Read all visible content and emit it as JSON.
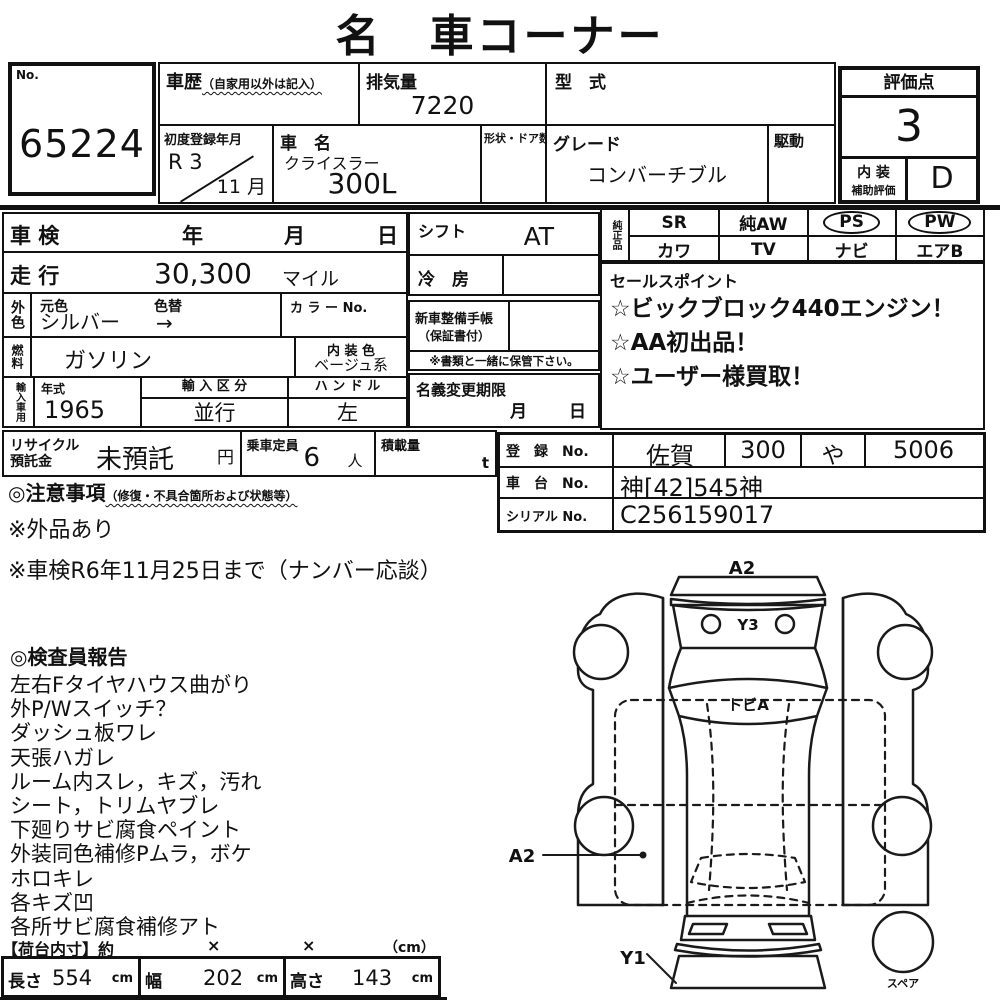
{
  "title": "名　車コーナー",
  "no_box": {
    "label": "No.",
    "value": "65224"
  },
  "header": {
    "history_label": "車歴",
    "history_note": "（自家用以外は記入）",
    "displacement_label": "排気量",
    "displacement_value": "7220",
    "model_code_label": "型　式",
    "first_reg_label": "初度登録年月",
    "first_reg_year": "R 3",
    "first_reg_month": "11 月",
    "car_name_label": "車　名",
    "car_maker": "クライスラー",
    "car_model": "300L",
    "body_doors_label": "形状・ドア数",
    "grade_label": "グレード",
    "grade_value": "コンバーチブル",
    "drive_label": "駆動"
  },
  "score": {
    "label": "評価点",
    "value": "3",
    "interior_label_top": "内 装",
    "interior_label_bottom": "補助評価",
    "interior_value": "D"
  },
  "left": {
    "shaken_label": "車 検",
    "year": "年",
    "month": "月",
    "day": "日",
    "mileage_label": "走 行",
    "mileage_value": "30,300",
    "mileage_unit": "マイル",
    "ext_color_label": "外色",
    "orig_color_label": "元色",
    "orig_color_value": "シルバー",
    "color_change_label": "色替",
    "color_change_value": "→",
    "color_no_label": "カ ラ ー No.",
    "fuel_label": "燃料",
    "fuel_value": "ガソリン",
    "int_color_label": "内 装 色",
    "int_color_value": "ベージュ系",
    "import_label": "輸入車用",
    "year_label": "年式",
    "year_value": "1965",
    "import_class_label": "輸 入 区 分",
    "import_class_value": "並行",
    "handle_label": "ハ ン ド ル",
    "handle_value": "左"
  },
  "middle": {
    "shift_label": "シフト",
    "shift_value": "AT",
    "ac_label": "冷　房",
    "service_book_label": "新車整備手帳",
    "service_book_note": "（保証書付）",
    "keep_note": "※書類と一緒に保管下さい。",
    "transfer_label": "名義変更期限",
    "transfer_month": "月",
    "transfer_day": "日"
  },
  "genuine": {
    "label": "純正品",
    "items": [
      {
        "label": "SR",
        "circled": false
      },
      {
        "label": "純AW",
        "circled": false
      },
      {
        "label": "PS",
        "circled": true
      },
      {
        "label": "PW",
        "circled": true
      },
      {
        "label": "カワ",
        "circled": false
      },
      {
        "label": "TV",
        "circled": false
      },
      {
        "label": "ナビ",
        "circled": false
      },
      {
        "label": "エアB",
        "circled": false
      }
    ]
  },
  "sales": {
    "label": "セールスポイント",
    "points": [
      "☆ビックブロック440エンジン！",
      "☆AA初出品！",
      "☆ユーザー様買取！"
    ]
  },
  "recycle": {
    "label_line1": "リサイクル",
    "label_line2": "預託金",
    "value": "未預託",
    "unit": "円",
    "capacity_label": "乗車定員",
    "capacity_value": "6",
    "capacity_unit": "人",
    "load_label": "積載量",
    "load_unit": "t"
  },
  "registration": {
    "reg_label": "登　録　No.",
    "reg_area": "佐賀",
    "reg_class": "300",
    "reg_kana": "や",
    "reg_number": "5006",
    "chassis_label": "車　台　No.",
    "chassis_value": "神[42]545神",
    "serial_label": "シリアル No.",
    "serial_value": "C256159017"
  },
  "cautions": {
    "heading": "◎注意事項",
    "heading_note": "（修復・不具合箇所および状態等）",
    "lines": [
      "※外品あり",
      "※車検R6年11月25日まで（ナンバー応談）"
    ]
  },
  "inspector": {
    "heading": "◎検査員報告",
    "lines": [
      "左右Fタイヤハウス曲がり",
      "外P/Wスイッチ？",
      "ダッシュ板ワレ",
      "天張ハガレ",
      "ルーム内スレ，キズ，汚れ",
      "シート，トリムヤブレ",
      "下廻りサビ腐食ペイント",
      "外装同色補修Pムラ，ボケ",
      "ホロキレ",
      "各キズ凹",
      "各所サビ腐食補修アト"
    ]
  },
  "dimensions": {
    "heading": "【荷台内寸】約",
    "times1": "×",
    "times2": "×",
    "unit_note": "（cm）",
    "cells": [
      {
        "label": "長さ",
        "value": "554",
        "unit": "cm"
      },
      {
        "label": "幅",
        "value": "202",
        "unit": "cm"
      },
      {
        "label": "高さ",
        "value": "143",
        "unit": "cm"
      }
    ]
  },
  "diagram": {
    "labels": {
      "rear": "A2",
      "y3": "Y3",
      "tobi": "トビA",
      "left_a2": "A2",
      "front": "Y1",
      "spare": "スペア"
    }
  }
}
